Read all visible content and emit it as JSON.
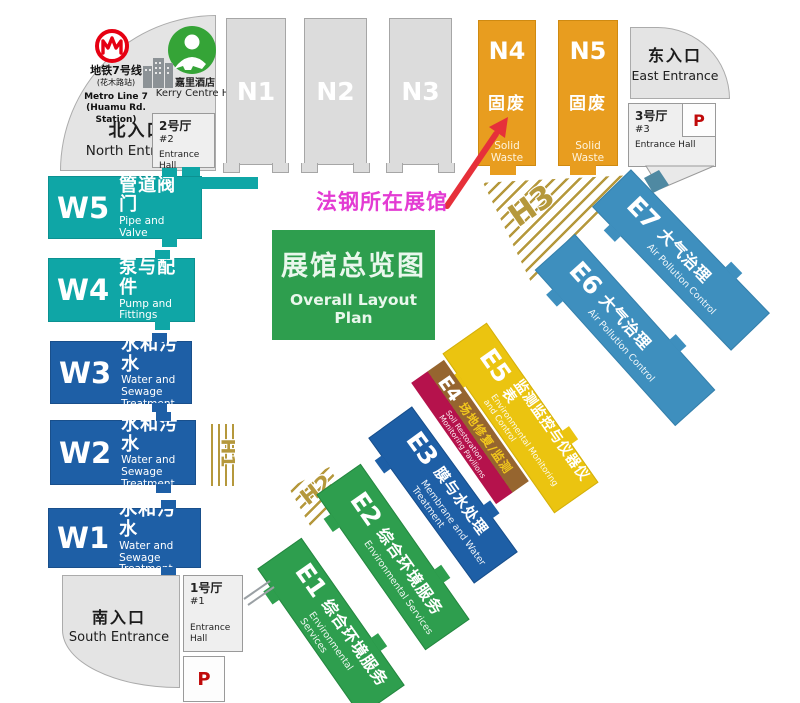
{
  "map_title": {
    "cn": "展馆总览图",
    "en": "Overall Layout Plan"
  },
  "annotation": {
    "label": "法钢所在展馆",
    "color": "#e33bd3",
    "arrow_color": "#e6303a",
    "points_to": "N4"
  },
  "north_area": {
    "metro_line1": "地铁7号线",
    "metro_line2": "(花木路站)",
    "metro_line3": "Metro Line 7",
    "metro_line4": "(Huamu Rd. Station)",
    "hotel_cn": "嘉里酒店",
    "hotel_en": "Kerry Centre Hotel",
    "entrance_cn": "北入口",
    "entrance_en": "North Entrance"
  },
  "east_area": {
    "entrance_cn": "东入口",
    "entrance_en": "East Entrance"
  },
  "south_area": {
    "entrance_cn": "南入口",
    "entrance_en": "South Entrance"
  },
  "entrance_halls": {
    "hall1": {
      "cn": "1号厅",
      "num": "#1",
      "en": "Entrance Hall"
    },
    "hall2": {
      "cn": "2号厅",
      "num": "#2",
      "en": "Entrance Hall"
    },
    "hall3": {
      "cn": "3号厅",
      "num": "#3",
      "en": "Entrance Hall"
    }
  },
  "parking": {
    "label": "P"
  },
  "hatches": {
    "h1": "H1",
    "h2": "H2",
    "h3": "H3"
  },
  "halls": {
    "n1": {
      "code": "N1"
    },
    "n2": {
      "code": "N2"
    },
    "n3": {
      "code": "N3"
    },
    "n4": {
      "code": "N4",
      "cn": "固废",
      "en": "Solid Waste"
    },
    "n5": {
      "code": "N5",
      "cn": "固废",
      "en": "Solid Waste"
    },
    "w5": {
      "code": "W5",
      "cn": "管道阀门",
      "en": "Pipe and Valve"
    },
    "w4": {
      "code": "W4",
      "cn": "泵与配件",
      "en": "Pump and Fittings"
    },
    "w3": {
      "code": "W3",
      "cn": "水和污水",
      "en": "Water and Sewage Treatment"
    },
    "w2": {
      "code": "W2",
      "cn": "水和污水",
      "en": "Water and Sewage Treatment"
    },
    "w1": {
      "code": "W1",
      "cn": "水和污水",
      "en": "Water and Sewage Treatment"
    },
    "e7": {
      "code": "E7",
      "cn": "大气治理",
      "en": "Air Pollution Control"
    },
    "e6": {
      "code": "E6",
      "cn": "大气治理",
      "en": "Air Pollution Control"
    },
    "e5": {
      "code": "E5",
      "cn": "监测监控与仪器仪表",
      "en": "Environmental Monitoring and Control"
    },
    "e4": {
      "code": "E4",
      "cn": "场地修复/监测",
      "en": "Soil Restoration Monitoring Pavilions"
    },
    "e3": {
      "code": "E3",
      "cn": "膜与水处理",
      "en": "Membrane and Water Treatment"
    },
    "e2": {
      "code": "E2",
      "cn": "综合环境服务",
      "en": "Environmental Services"
    },
    "e1": {
      "code": "E1",
      "cn": "综合环境服务",
      "en": "Environmental Services"
    }
  },
  "colors": {
    "teal": "#0fa6a6",
    "blue": "#1e5fa6",
    "light_blue": "#3e8fbe",
    "green": "#2e9e4e",
    "yellow": "#ebc410",
    "orange": "#e89d1f",
    "brown": "#96652f",
    "crimson": "#b5124c",
    "hatch_gold": "#b5983c",
    "gray_hall": "#dcdcdc",
    "metro_red": "#e60012",
    "hotel_green": "#35a437",
    "parking_red": "#c00a0a"
  }
}
